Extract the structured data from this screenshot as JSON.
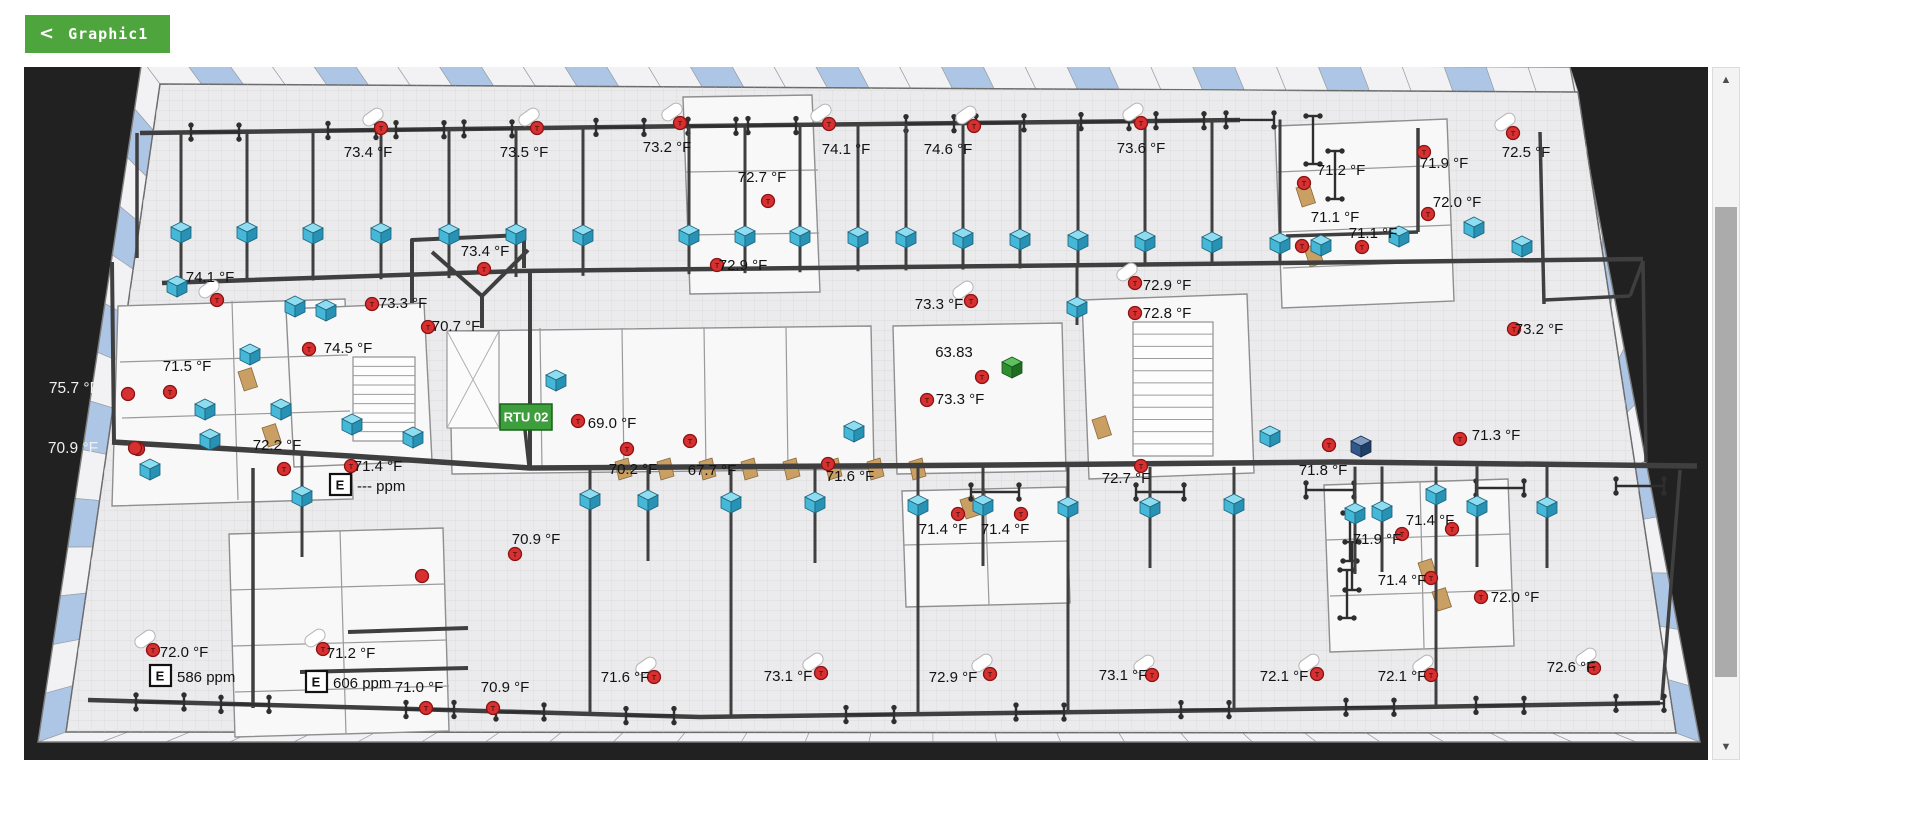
{
  "toolbar": {
    "back_icon": "<",
    "title": "Graphic1"
  },
  "colors": {
    "button_green": "#4FA53D",
    "rtu_green": "#3E9E3E",
    "cube_blue": "#45B8D8",
    "sensor_red": "#D63030",
    "canvas_bg": "#212121",
    "duct": "#3F3F3F",
    "navy_cube": "#32598A",
    "window_blue": "#ADC6E6",
    "label_color": "#121212"
  },
  "scrollbar": {
    "up_icon": "▲",
    "down_icon": "▼"
  },
  "plan": {
    "temps": [
      {
        "t": "73.4 °F",
        "lx": 368,
        "ly": 153,
        "cx": 381,
        "cy": 128,
        "pill": true
      },
      {
        "t": "73.5 °F",
        "lx": 524,
        "ly": 153,
        "cx": 537,
        "cy": 128,
        "pill": true
      },
      {
        "t": "73.2 °F",
        "lx": 667,
        "ly": 148,
        "cx": 680,
        "cy": 123,
        "pill": true
      },
      {
        "t": "74.1 °F",
        "lx": 846,
        "ly": 150,
        "cx": 829,
        "cy": 124,
        "pill": true
      },
      {
        "t": "74.6 °F",
        "lx": 948,
        "ly": 150,
        "cx": 974,
        "cy": 126,
        "pill": true
      },
      {
        "t": "73.6 °F",
        "lx": 1141,
        "ly": 149,
        "cx": 1141,
        "cy": 123,
        "pill": true
      },
      {
        "t": "71.2 °F",
        "lx": 1341,
        "ly": 171,
        "cx": 1304,
        "cy": 183,
        "pill": false
      },
      {
        "t": "71.9 °F",
        "lx": 1444,
        "ly": 164,
        "cx": 1424,
        "cy": 152,
        "pill": false
      },
      {
        "t": "72.5 °F",
        "lx": 1526,
        "ly": 153,
        "cx": 1513,
        "cy": 133,
        "pill": true
      },
      {
        "t": "72.0 °F",
        "lx": 1457,
        "ly": 203,
        "cx": 1428,
        "cy": 214,
        "pill": false
      },
      {
        "t": "71.1 °F",
        "lx": 1335,
        "ly": 218,
        "cx": 1302,
        "cy": 246,
        "pill": false
      },
      {
        "t": "71.1 °F",
        "lx": 1373,
        "ly": 234,
        "cx": 1362,
        "cy": 247,
        "pill": false
      },
      {
        "t": "72.7 °F",
        "lx": 762,
        "ly": 178,
        "cx": 768,
        "cy": 201,
        "pill": false
      },
      {
        "t": "72.9 °F",
        "lx": 743,
        "ly": 266,
        "cx": 717,
        "cy": 265,
        "pill": false
      },
      {
        "t": "73.4 °F",
        "lx": 485,
        "ly": 252,
        "cx": 484,
        "cy": 269,
        "pill": false
      },
      {
        "t": "74.1 °F",
        "lx": 210,
        "ly": 278,
        "cx": 217,
        "cy": 300,
        "pill": true
      },
      {
        "t": "73.3 °F",
        "lx": 403,
        "ly": 304,
        "cx": 372,
        "cy": 304,
        "pill": false
      },
      {
        "t": "70.7 °F",
        "lx": 456,
        "ly": 327,
        "cx": 428,
        "cy": 327,
        "pill": false
      },
      {
        "t": "74.5 °F",
        "lx": 348,
        "ly": 349,
        "cx": 309,
        "cy": 349,
        "pill": false
      },
      {
        "t": "71.5 °F",
        "lx": 187,
        "ly": 367,
        "cx": 170,
        "cy": 392,
        "pill": false
      },
      {
        "t": "72.2 °F",
        "lx": 277,
        "ly": 446,
        "cx": 284,
        "cy": 469,
        "pill": false
      },
      {
        "t": "71.4 °F",
        "lx": 378,
        "ly": 467,
        "cx": 351,
        "cy": 466,
        "pill": false
      },
      {
        "t": "69.0 °F",
        "lx": 612,
        "ly": 424,
        "cx": 578,
        "cy": 421,
        "pill": false
      },
      {
        "t": "63.83",
        "lx": 954,
        "ly": 353,
        "cx": 982,
        "cy": 377,
        "pill": false
      },
      {
        "t": "73.3 °F",
        "lx": 939,
        "ly": 305,
        "cx": 971,
        "cy": 301,
        "pill": true
      },
      {
        "t": "73.3 °F",
        "lx": 960,
        "ly": 400,
        "cx": 927,
        "cy": 400,
        "pill": false
      },
      {
        "t": "72.9 °F",
        "lx": 1167,
        "ly": 286,
        "cx": 1135,
        "cy": 283,
        "pill": true
      },
      {
        "t": "72.8 °F",
        "lx": 1167,
        "ly": 314,
        "cx": 1135,
        "cy": 313,
        "pill": false
      },
      {
        "t": "73.2 °F",
        "lx": 1539,
        "ly": 330,
        "cx": 1514,
        "cy": 329,
        "pill": false
      },
      {
        "t": "70.2 °F",
        "lx": 633,
        "ly": 470,
        "cx": 627,
        "cy": 449,
        "pill": false
      },
      {
        "t": "67.7 °F",
        "lx": 712,
        "ly": 471,
        "cx": 690,
        "cy": 441,
        "pill": false
      },
      {
        "t": "71.6 °F",
        "lx": 850,
        "ly": 477,
        "cx": 828,
        "cy": 464,
        "pill": false
      },
      {
        "t": "72.7 °F",
        "lx": 1126,
        "ly": 479,
        "cx": 1141,
        "cy": 466,
        "pill": false
      },
      {
        "t": "71.8 °F",
        "lx": 1323,
        "ly": 471,
        "cx": 1329,
        "cy": 445,
        "pill": false
      },
      {
        "t": "71.3 °F",
        "lx": 1496,
        "ly": 436,
        "cx": 1460,
        "cy": 439,
        "pill": false
      },
      {
        "t": "70.9 °F",
        "lx": 536,
        "ly": 540,
        "cx": 515,
        "cy": 554,
        "pill": false
      },
      {
        "t": "71.4 °F",
        "lx": 943,
        "ly": 530,
        "cx": 958,
        "cy": 514,
        "pill": false
      },
      {
        "t": "71.4 °F",
        "lx": 1005,
        "ly": 530,
        "cx": 1021,
        "cy": 514,
        "pill": false
      },
      {
        "t": "71.9 °F",
        "lx": 1377,
        "ly": 540,
        "cx": 1402,
        "cy": 534,
        "pill": false
      },
      {
        "t": "71.4 °F",
        "lx": 1430,
        "ly": 521,
        "cx": 1452,
        "cy": 529,
        "pill": false
      },
      {
        "t": "71.4 °F",
        "lx": 1402,
        "ly": 581,
        "cx": 1431,
        "cy": 578,
        "pill": false
      },
      {
        "t": "72.0 °F",
        "lx": 1515,
        "ly": 598,
        "cx": 1481,
        "cy": 597,
        "pill": false
      },
      {
        "t": "72.0 °F",
        "lx": 184,
        "ly": 653,
        "cx": 153,
        "cy": 650,
        "pill": true
      },
      {
        "t": "71.2 °F",
        "lx": 351,
        "ly": 654,
        "cx": 323,
        "cy": 649,
        "pill": true
      },
      {
        "t": "71.0 °F",
        "lx": 419,
        "ly": 688,
        "cx": 426,
        "cy": 708,
        "pill": false
      },
      {
        "t": "70.9 °F",
        "lx": 505,
        "ly": 688,
        "cx": 493,
        "cy": 708,
        "pill": false
      },
      {
        "t": "71.6 °F",
        "lx": 625,
        "ly": 678,
        "cx": 654,
        "cy": 677,
        "pill": true
      },
      {
        "t": "73.1 °F",
        "lx": 788,
        "ly": 677,
        "cx": 821,
        "cy": 673,
        "pill": true
      },
      {
        "t": "72.9 °F",
        "lx": 953,
        "ly": 678,
        "cx": 990,
        "cy": 674,
        "pill": true
      },
      {
        "t": "73.1 °F",
        "lx": 1123,
        "ly": 676,
        "cx": 1152,
        "cy": 675,
        "pill": true
      },
      {
        "t": "72.1 °F",
        "lx": 1284,
        "ly": 677,
        "cx": 1317,
        "cy": 674,
        "pill": true
      },
      {
        "t": "72.1 °F",
        "lx": 1402,
        "ly": 677,
        "cx": 1431,
        "cy": 675,
        "pill": true
      },
      {
        "t": "72.6 °F",
        "lx": 1571,
        "ly": 668,
        "cx": 1594,
        "cy": 668,
        "pill": true
      }
    ],
    "white_temps": [
      {
        "t": "75.7 °F",
        "lx": 74,
        "ly": 389
      },
      {
        "t": "70.9 °F",
        "lx": 73,
        "ly": 449
      }
    ],
    "extra_dots": [
      [
        128,
        394
      ],
      [
        138,
        449
      ],
      [
        422,
        576
      ],
      [
        135,
        448
      ]
    ],
    "ppm_sensors": [
      {
        "t": "--- ppm",
        "icon": "E",
        "bx": 330,
        "by": 474
      },
      {
        "t": "586 ppm",
        "icon": "E",
        "bx": 150,
        "by": 665
      },
      {
        "t": "606 ppm",
        "icon": "E",
        "bx": 306,
        "by": 671
      }
    ],
    "rtu": {
      "label": "RTU 02",
      "x": 500,
      "y": 404,
      "w": 52,
      "h": 26
    },
    "green_cube": [
      1012,
      368
    ],
    "navy_cube": [
      1361,
      447
    ],
    "cubes": [
      [
        181,
        233
      ],
      [
        247,
        233
      ],
      [
        313,
        234
      ],
      [
        381,
        234
      ],
      [
        449,
        235
      ],
      [
        516,
        235
      ],
      [
        583,
        236
      ],
      [
        689,
        236
      ],
      [
        745,
        237
      ],
      [
        800,
        237
      ],
      [
        858,
        238
      ],
      [
        906,
        238
      ],
      [
        963,
        239
      ],
      [
        1020,
        240
      ],
      [
        1078,
        241
      ],
      [
        1145,
        242
      ],
      [
        1212,
        243
      ],
      [
        1280,
        244
      ],
      [
        1321,
        246
      ],
      [
        1399,
        237
      ],
      [
        1474,
        228
      ],
      [
        1522,
        247
      ],
      [
        295,
        307
      ],
      [
        326,
        311
      ],
      [
        250,
        355
      ],
      [
        177,
        287
      ],
      [
        205,
        410
      ],
      [
        281,
        410
      ],
      [
        210,
        440
      ],
      [
        352,
        425
      ],
      [
        413,
        438
      ],
      [
        150,
        470
      ],
      [
        302,
        497
      ],
      [
        556,
        381
      ],
      [
        854,
        432
      ],
      [
        1077,
        308
      ],
      [
        1270,
        437
      ],
      [
        590,
        500
      ],
      [
        648,
        501
      ],
      [
        731,
        503
      ],
      [
        815,
        503
      ],
      [
        918,
        506
      ],
      [
        983,
        506
      ],
      [
        1068,
        508
      ],
      [
        1150,
        508
      ],
      [
        1234,
        505
      ],
      [
        1355,
        514
      ],
      [
        1382,
        512
      ],
      [
        1436,
        495
      ],
      [
        1477,
        507
      ],
      [
        1547,
        508
      ]
    ]
  }
}
